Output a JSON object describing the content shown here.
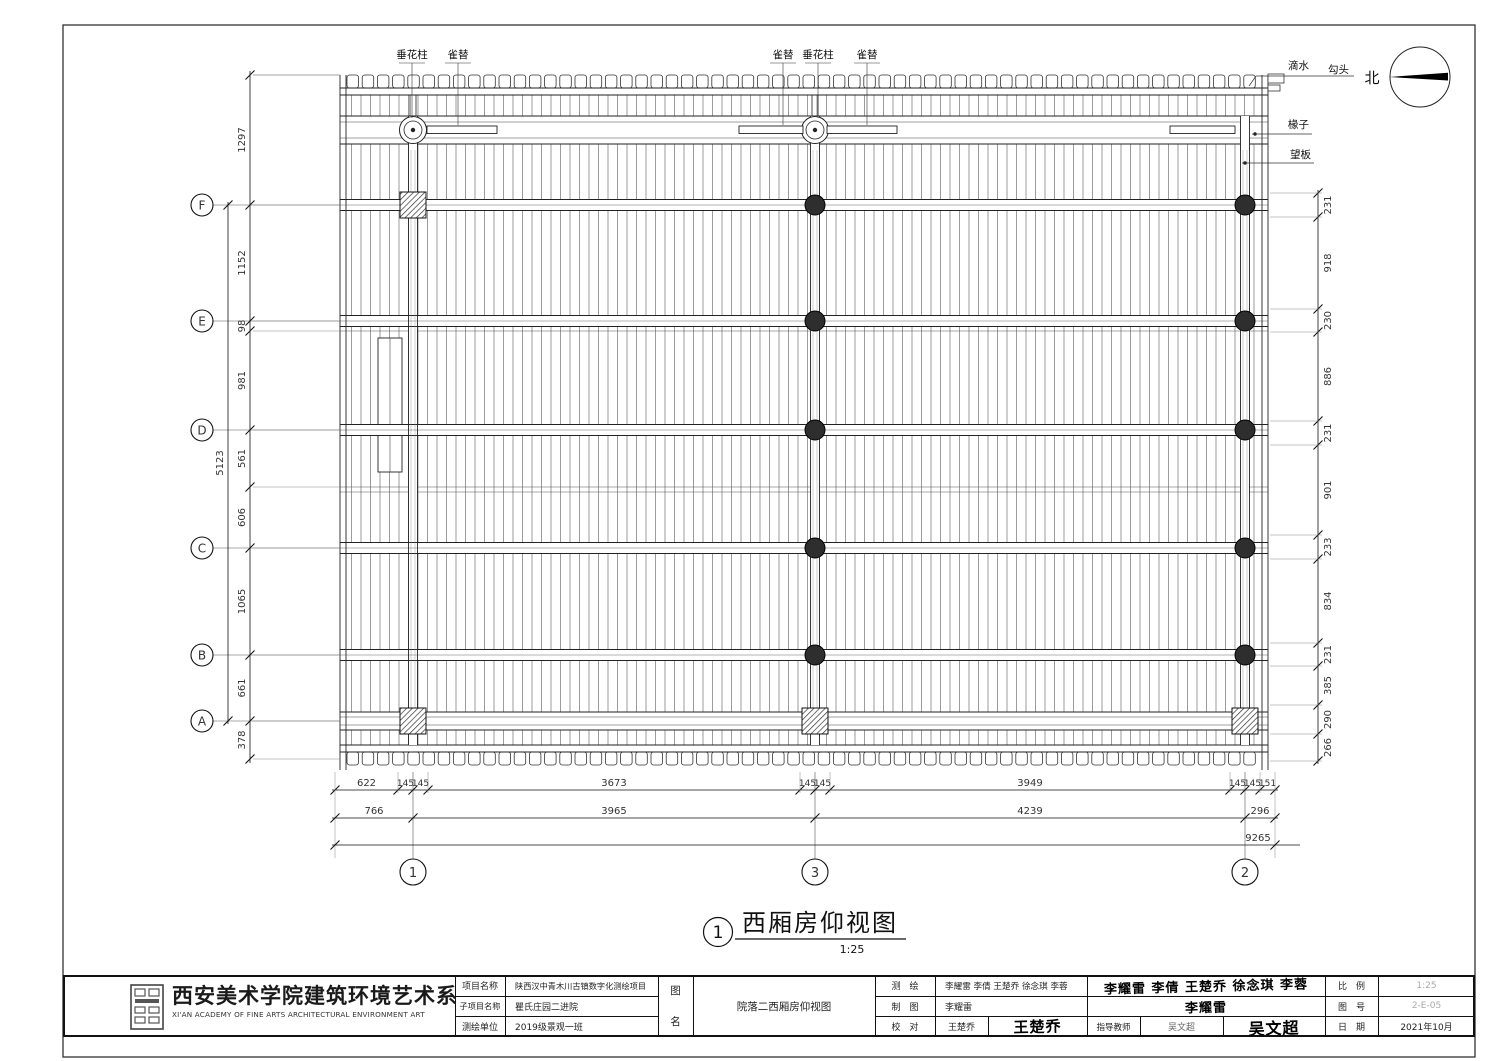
{
  "sheet": {
    "north_label": "北",
    "title": "西厢房仰视图",
    "title_bubble": "1",
    "scale": "1:25"
  },
  "annotations": {
    "top": [
      "垂花柱",
      "雀替",
      "雀替",
      "垂花柱",
      "雀替"
    ],
    "right": [
      "滴水",
      "勾头",
      "椽子",
      "望板"
    ]
  },
  "grid": {
    "rows": [
      "F",
      "E",
      "D",
      "C",
      "B",
      "A"
    ],
    "cols": [
      "1",
      "3",
      "2"
    ]
  },
  "dimensions": {
    "left_chain": [
      "1297",
      "1152",
      "98",
      "981",
      "561",
      "606",
      "1065",
      "661",
      "378"
    ],
    "left_total": "5123",
    "right_chain": [
      "231",
      "918",
      "230",
      "886",
      "231",
      "901",
      "233",
      "834",
      "231",
      "385",
      "290",
      "266"
    ],
    "bottom_row1": [
      "622",
      "145",
      "145",
      "3673",
      "145",
      "145",
      "3949",
      "145",
      "145",
      "151"
    ],
    "bottom_row2": [
      "766",
      "3965",
      "4239",
      "296"
    ],
    "bottom_total": "9265"
  },
  "title_block": {
    "org_cn": "西安美术学院建筑环境艺术系",
    "org_en": "XI'AN ACADEMY OF FINE ARTS ARCHITECTURAL ENVIRONMENT ART",
    "project_label": "项目名称",
    "project_value": "陕西汉中青木川古镇数字化测绘项目",
    "subproject_label": "子项目名称",
    "subproject_value": "瞿氏庄园二进院",
    "unit_label": "测绘单位",
    "unit_value": "2019级景观一班",
    "fig_label_top": "图",
    "fig_label_bottom": "名",
    "fig_name": "院落二西厢房仰视图",
    "survey_label": "测　绘",
    "survey_value": "李耀雷 李倩 王楚乔 徐念琪 李蓉",
    "survey_signature": "李耀雷 李倩 王楚乔 徐念琪 李蓉",
    "draft_label": "制　图",
    "draft_value": "李耀雷",
    "draft_signature": "李耀雷",
    "check_label": "校　对",
    "check_value": "王楚乔",
    "check_signature": "王楚乔",
    "advisor_label": "指导教师",
    "advisor_value": "吴文超",
    "advisor_signature": "吴文超",
    "scale_label": "比　例",
    "scale_value": "1:25",
    "figno_label": "图　号",
    "figno_value": "2-E-05",
    "date_label": "日　期",
    "date_value": "2021年10月"
  }
}
